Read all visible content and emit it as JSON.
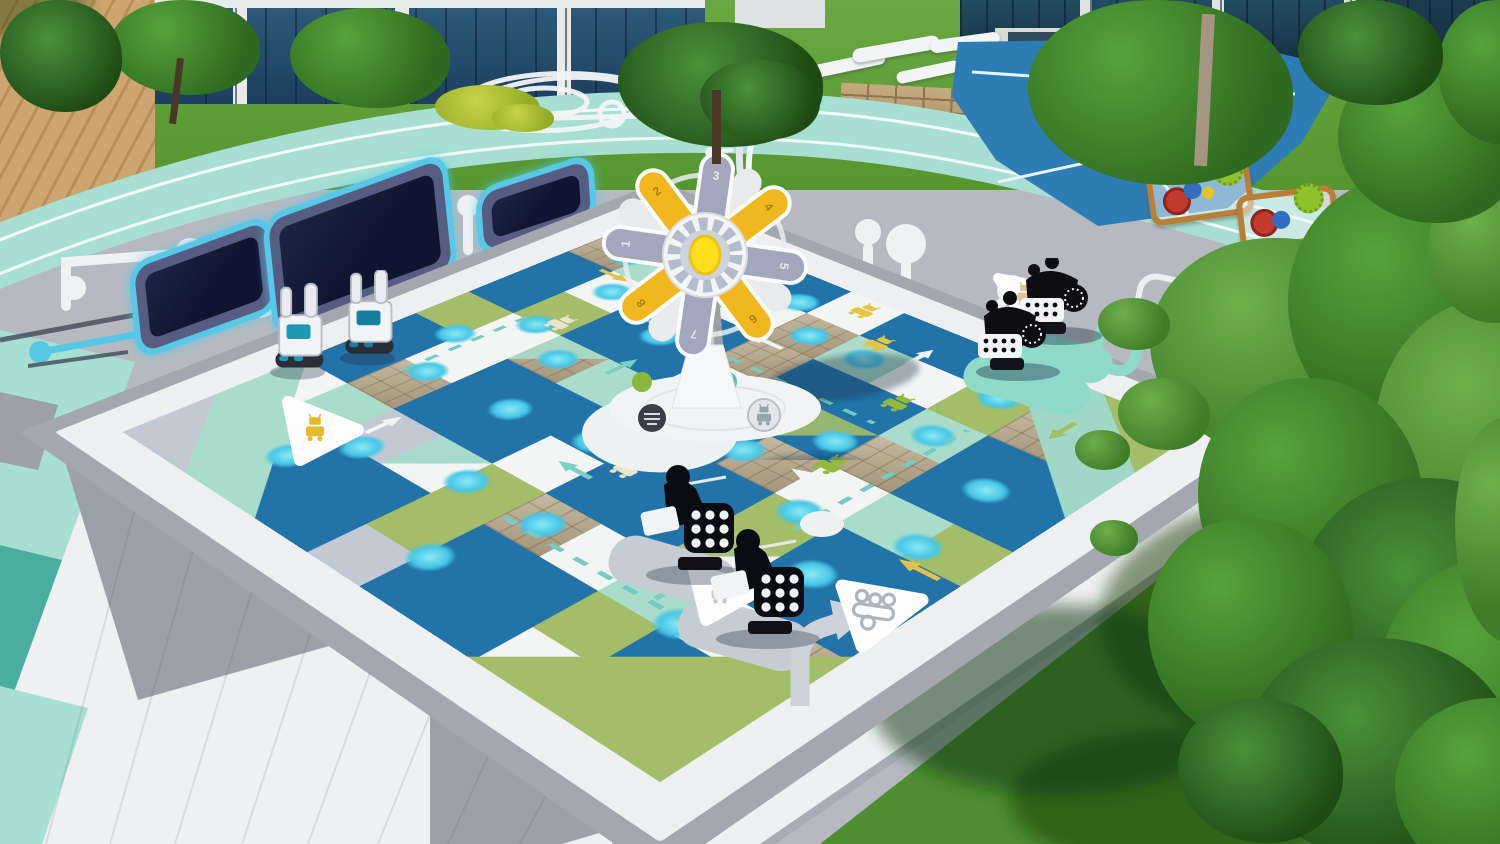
{
  "scene": {
    "title": "Aerial 3D render of a robot-technology themed playground plaza",
    "time_of_day": "day",
    "style": "architectural visualization"
  },
  "palette": {
    "board_blue": "#2173a8",
    "cell_white": "#f3f5f4",
    "cell_green": "#a3bd68",
    "cell_mint": "#a9dcca",
    "cell_gray": "#c3c9d3",
    "cell_stone": "#b9aa8e",
    "cyan_dot": "#46c6e6",
    "mint_path": "#a7dfd2",
    "deep_teal": "#4aae9e",
    "plaza_gray": "#b6bac0",
    "walkway_white": "#eef0f1",
    "grass_green": "#4c8e31",
    "tree_green": "#3f7d28",
    "petal_yellow": "#f1b71f",
    "petal_gray": "#a3a7bd",
    "hub_yellow": "#ffdf1e",
    "trampoline_mat": "#141c38",
    "trampoline_glow": "#57c8e6",
    "stream_blue": "#2e7cb4",
    "wood": "#b97f36",
    "robot_black": "#0d0d12",
    "robot_white": "#f1f3f5"
  },
  "sculpture": {
    "type": "gear-flower pinwheel on white pedestal",
    "petal_numbers": [
      "1",
      "2",
      "3",
      "4",
      "5",
      "6",
      "7",
      "8"
    ],
    "hub": "gear-icon",
    "base": "white circular plinth with robot medallions"
  },
  "board": {
    "description": "giant blue game board painted on ground with checkered lanes, cyan dots, arrows, dashed lines and robot glyphs",
    "marker_triangles": 4,
    "lane_cell_colors": [
      "white",
      "green",
      "mint",
      "gray",
      "stone"
    ]
  },
  "equipment": [
    {
      "name": "in-ground-trampoline",
      "count": 3
    },
    {
      "name": "wooden-gear-play-panel",
      "count": 2
    },
    {
      "name": "white-robot-spring-rider",
      "count": 2
    },
    {
      "name": "black-robot-rocker",
      "count": 2
    },
    {
      "name": "black-robot-seesaw",
      "count": 2
    }
  ],
  "environment": {
    "top": "glass facade buildings with lawns and trees",
    "right": "large foreground tree over grass lawn",
    "left": "mint pedestrian paths and white walkways",
    "details": [
      "circuit-trace ground graphics",
      "white wireframe ground sculpture",
      "curved light pole",
      "stone retaining wall",
      "log benches"
    ]
  }
}
